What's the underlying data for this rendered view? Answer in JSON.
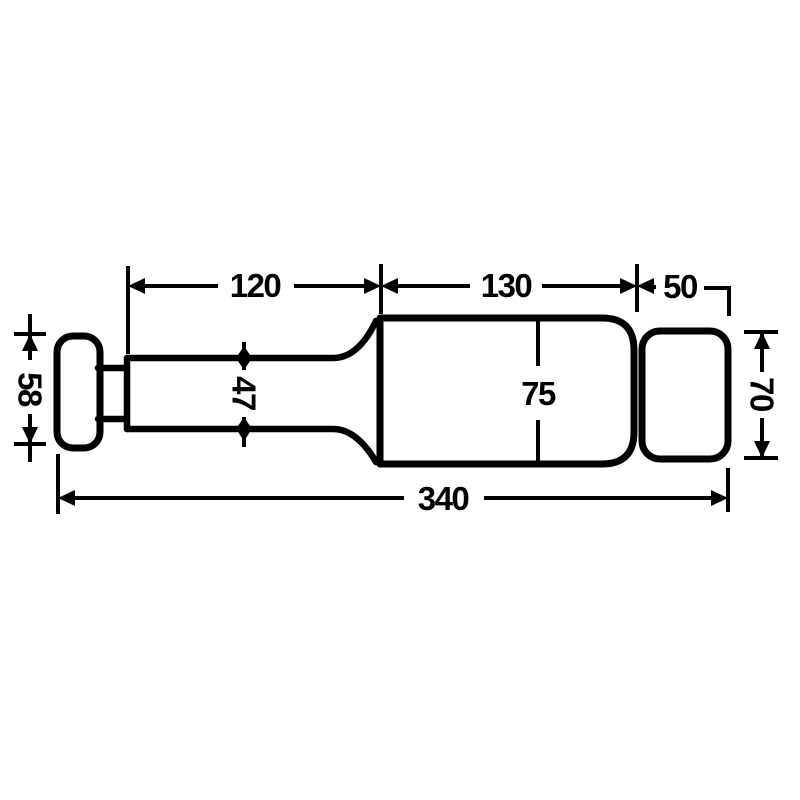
{
  "drawing": {
    "description": "black-and-white technical line drawing of a cylindrical roller / buffer part, side view, with millimetre dimensions",
    "background_color": "#ffffff",
    "line_color": "#000000",
    "dims": {
      "top_shaft_length": "120",
      "top_body_length": "130",
      "top_end_length": "50",
      "body_diameter": "75",
      "shaft_diameter": "47",
      "cap_diameter": "58",
      "end_diameter": "70",
      "overall_length": "340"
    }
  }
}
